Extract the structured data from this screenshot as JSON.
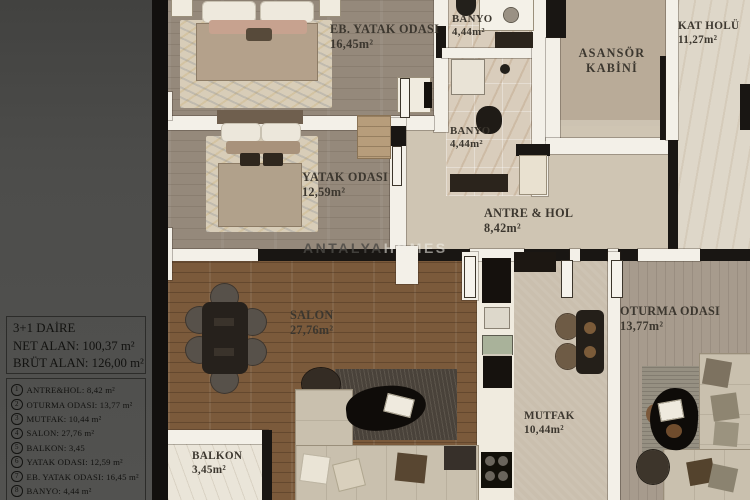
{
  "legend": {
    "title": "3+1 DAİRE",
    "net_alan": "NET ALAN: 100,37  m²",
    "brut_alan": "BRÜT ALAN: 126,00 m²",
    "items": [
      {
        "num": "1",
        "label": "ANTRE&HOL: 8,42 m²"
      },
      {
        "num": "2",
        "label": "OTURMA ODASI: 13,77 m²"
      },
      {
        "num": "3",
        "label": "MUTFAK: 10,44 m²"
      },
      {
        "num": "4",
        "label": "SALON: 27,76 m²"
      },
      {
        "num": "5",
        "label": "BALKON: 3,45"
      },
      {
        "num": "6",
        "label": "YATAK ODASI: 12,59 m²"
      },
      {
        "num": "7",
        "label": "EB. YATAK ODASI: 16,45 m²"
      },
      {
        "num": "8",
        "label": "BANYO: 4,44 m²"
      },
      {
        "num": "9",
        "label": ""
      }
    ]
  },
  "rooms": {
    "eb_yatak": {
      "name": "EB. YATAK ODASI",
      "area": "16,45m²"
    },
    "banyo_top": {
      "name": "BANYO",
      "area": "4,44m²"
    },
    "asansor": {
      "line1": "ASANSÖR",
      "line2": "KABİNİ"
    },
    "kat_holu": {
      "name": "KAT HOLÜ",
      "area": "11,27m²"
    },
    "yatak": {
      "name": "YATAK ODASI",
      "area": "12,59m²"
    },
    "banyo_mid": {
      "name": "BANYO",
      "area": "4,44m²"
    },
    "antre": {
      "name": "ANTRE & HOL",
      "area": "8,42m²"
    },
    "salon": {
      "name": "SALON",
      "area": "27,76m²"
    },
    "balkon": {
      "name": "BALKON",
      "area": "3,45m²"
    },
    "mutfak": {
      "name": "MUTFAK",
      "area": "10,44m²"
    },
    "oturma": {
      "name": "OTURMA ODASI",
      "area": "13,77m²"
    }
  },
  "watermark": {
    "left": "ANTALYA",
    "right": "HOMES"
  },
  "colors": {
    "wall": "#f3f0e8",
    "wall_dark": "#191613",
    "salon_floor": "#7b5a3b",
    "label_text": "#3c372f",
    "sidebar_bg": "#4b4b49"
  }
}
